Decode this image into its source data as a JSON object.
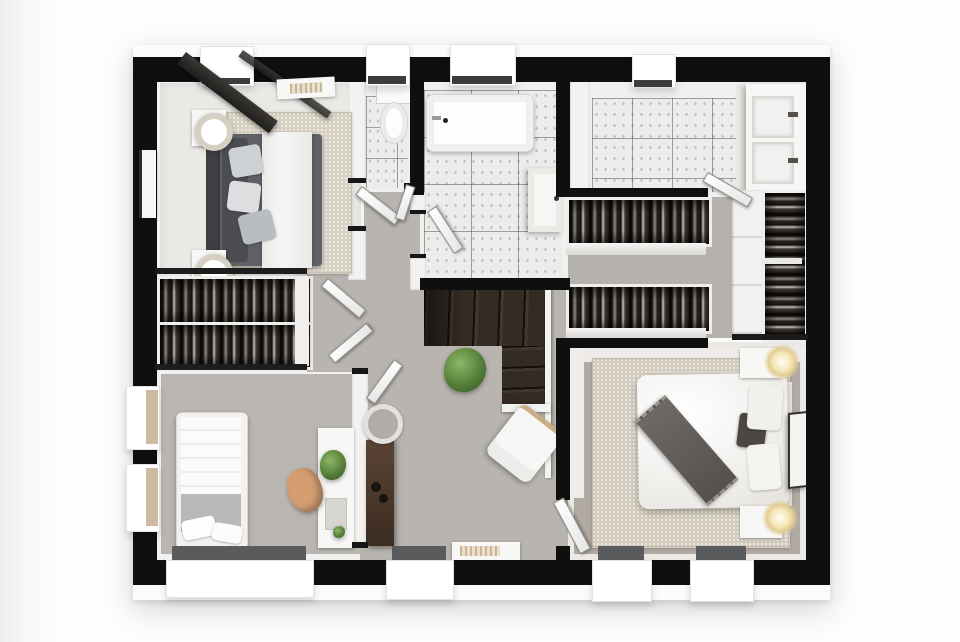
{
  "meta": {
    "kind": "3d-floor-plan-render",
    "view": "top-down",
    "level": "first-floor"
  },
  "palette": {
    "wall_black": "#0f0f0f",
    "slab_white": "#fbfbfa",
    "floor_light": "#eae9e6",
    "hall_gray": "#b8b4af",
    "carpet_gray": "#b1aaa3",
    "rug_beige": "#d8d1c2",
    "rug_beige_dark": "#d4cdbf",
    "bed_gray": "#5f6166",
    "stair_wood": "#342b23",
    "console_wood": "#4a3729",
    "chair_tan": "#d49e71",
    "plant_green": "#55803a",
    "tile_marble": "#ecedeb",
    "lamp_warm": "#f3e3ae",
    "window_glass": "#595b5c",
    "white": "#fdfdfd"
  },
  "rooms": [
    {
      "id": "bedroom-1",
      "name": "Bedroom 1",
      "furniture": [
        "double bed with white runner",
        "dark headboard",
        "2 nightstands",
        "2 round table lamps",
        "beige area rug",
        "wall art",
        "ceiling beams",
        "ceiling vent"
      ]
    },
    {
      "id": "wardrobe-nook",
      "name": "Built-in wardrobe",
      "furniture": [
        "2 clothes racks",
        "open double doors"
      ]
    },
    {
      "id": "bedroom-2",
      "name": "Bedroom 2",
      "furniture": [
        "single bed",
        "2 pillows",
        "white desk",
        "desk plant",
        "tan office chair"
      ]
    },
    {
      "id": "landing",
      "name": "Landing / hallway",
      "furniture": [
        "winder staircase",
        "white banister",
        "potted plant",
        "white lounge chair",
        "wood console table",
        "round mirror",
        "floor vent"
      ]
    },
    {
      "id": "wc",
      "name": "WC",
      "furniture": [
        "toilet"
      ]
    },
    {
      "id": "bathroom",
      "name": "Bathroom",
      "furniture": [
        "bathtub",
        "wall vanity with sink"
      ]
    },
    {
      "id": "ensuite",
      "name": "En-suite bathroom",
      "furniture": [
        "double vanity",
        "2 sinks with faucets"
      ]
    },
    {
      "id": "walk-in-closet",
      "name": "Walk-in closet",
      "furniture": [
        "2 clothes racks",
        "tall wardrobe with clothes"
      ]
    },
    {
      "id": "master-bedroom",
      "name": "Master bedroom",
      "furniture": [
        "double bed",
        "gray throw blanket",
        "dark cushion",
        "2 white pillows",
        "2 nightstands",
        "2 glowing lamps",
        "beige area rug",
        "leaning art frame"
      ]
    }
  ],
  "openings": {
    "windows_top": 4,
    "windows_bottom": 4,
    "windows_left": 2,
    "doors": 7
  }
}
